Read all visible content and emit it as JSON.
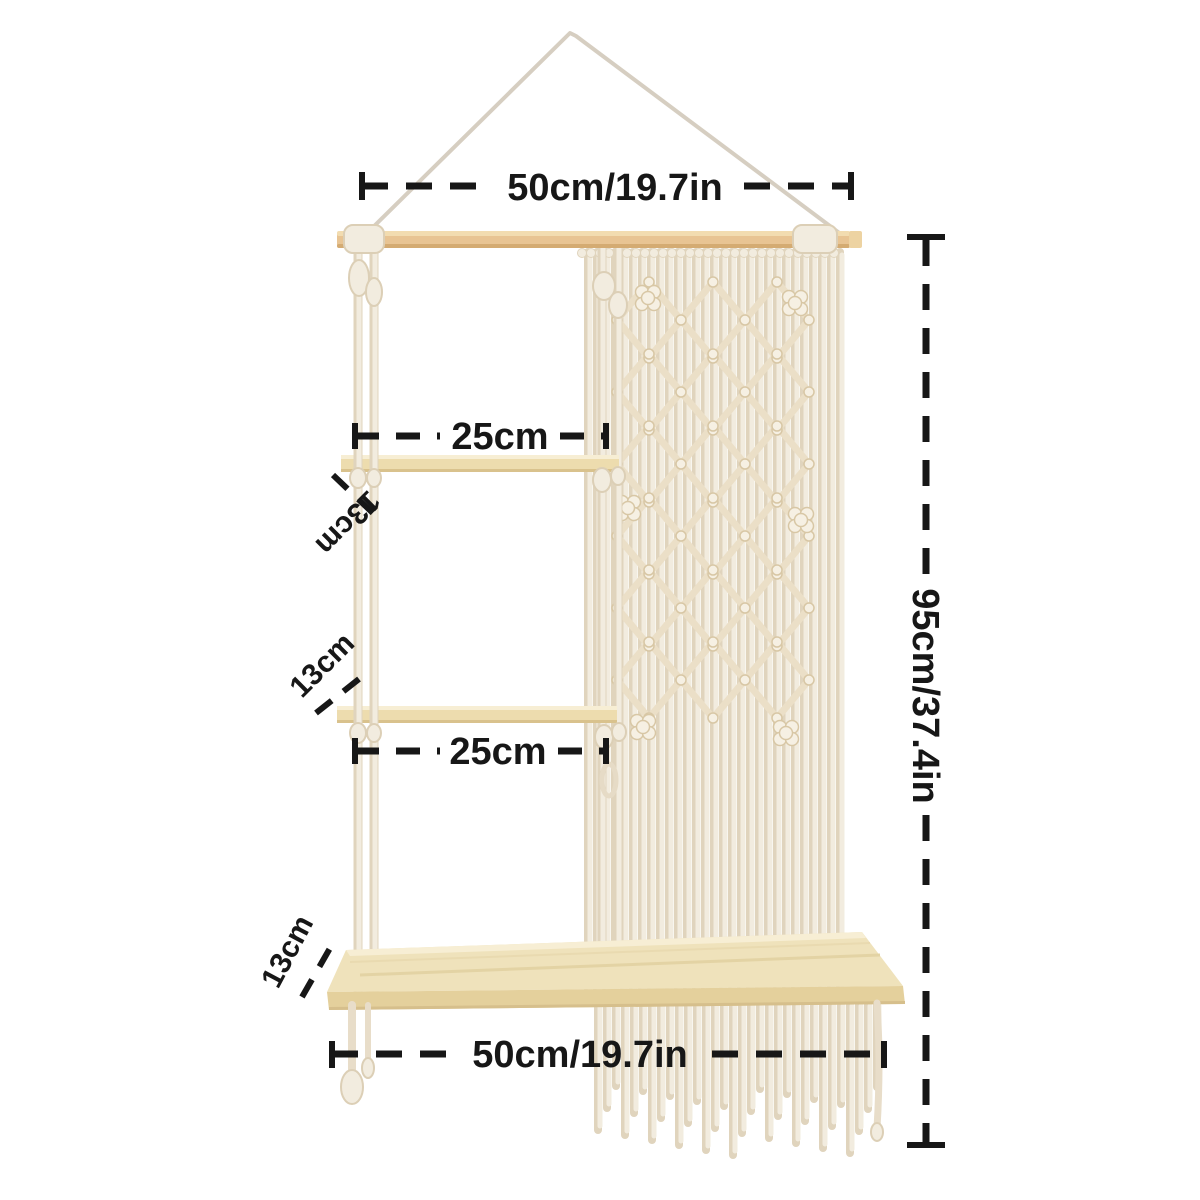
{
  "dimensions": {
    "top_width": "50cm/19.7in",
    "upper_shelf_width": "25cm",
    "middle_shelf_width": "25cm",
    "bottom_width": "50cm/19.7in",
    "total_height": "95cm/37.4in",
    "upper_shelf_depth": "13cm",
    "middle_shelf_depth": "13cm",
    "bottom_shelf_depth": "13cm"
  },
  "colors": {
    "annotation": "#171717",
    "background": "#ffffff",
    "hanging_string": "#d6cec1",
    "wood_rod": "#e8c493",
    "wood_rod_highlight": "#f2dcb0",
    "wood_rod_edge": "#d4ab72",
    "wood_shelf": "#eddcae",
    "wood_shelf_highlight": "#f7eed4",
    "wood_shelf_edge": "#d9c28d",
    "wood_bottom_shelf_top": "#efe2bb",
    "wood_bottom_shelf_front": "#e4d09c",
    "cord": "#f2ecdf",
    "cord_shadow": "#e0d4bd",
    "lattice": "#ebdfc7",
    "knot_fill": "#f6f0e3",
    "knot_edge": "#d8c7a5"
  }
}
